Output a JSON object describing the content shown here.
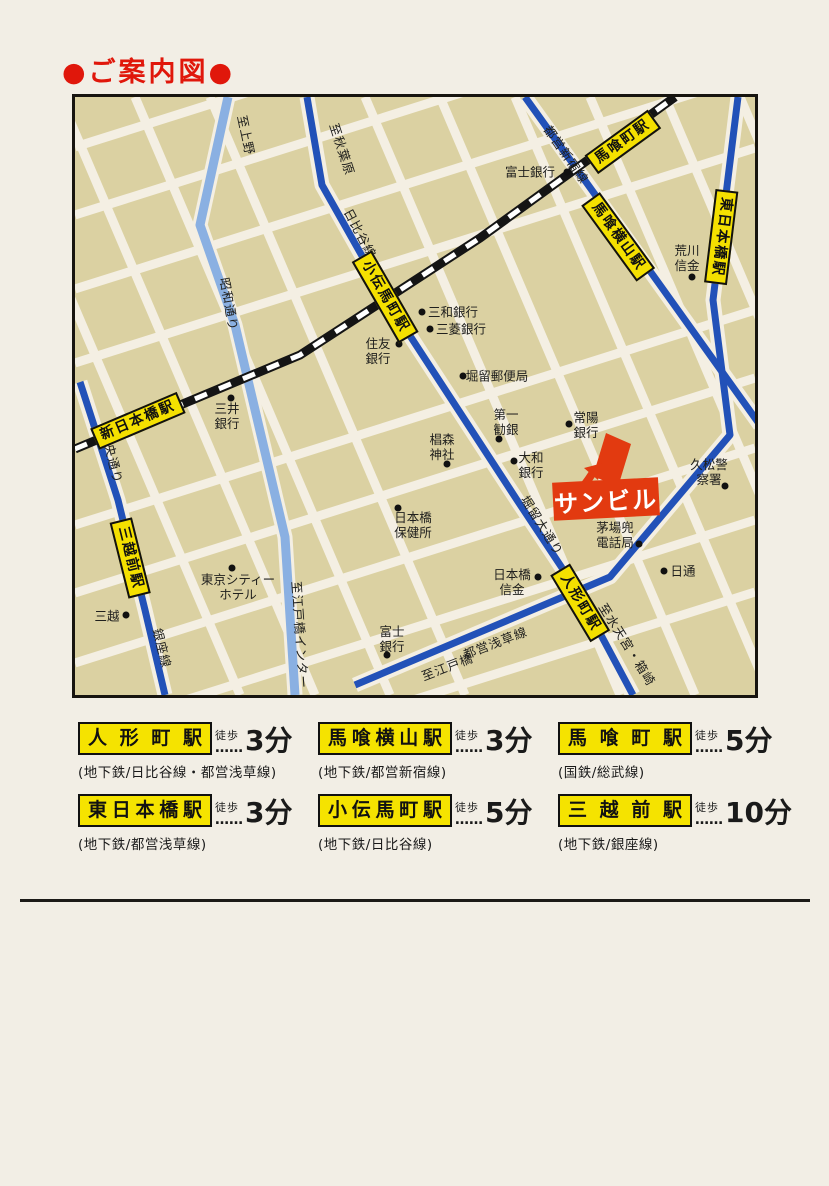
{
  "page": {
    "title": "●ご案内図●"
  },
  "colors": {
    "accent_red": "#e0170b",
    "map_bg": "#dbd1a2",
    "road_white": "#f4efe3",
    "subway_dark_blue": "#2251b8",
    "road_light_blue": "#8ab0e2",
    "station_yellow": "#f4e000",
    "building_red": "#e23a10",
    "railway_black": "#111111"
  },
  "map": {
    "building": {
      "name": "sun-building",
      "label": "サンビル"
    },
    "stations": [
      {
        "name": "shin-nihombashi",
        "text": "新日本橋駅",
        "x": 63,
        "y": 324,
        "rot": -23
      },
      {
        "name": "bakurocho",
        "text": "馬喰町駅",
        "x": 548,
        "y": 45,
        "rot": -36
      },
      {
        "name": "bakuro-yokoyama",
        "text": "馬喰横山駅",
        "x": 543,
        "y": 140,
        "rot": 54
      },
      {
        "name": "higashi-nihombashi",
        "text": "東日本橋駅",
        "x": 646,
        "y": 140,
        "rot": 97
      },
      {
        "name": "kodemmacho",
        "text": "小伝馬町駅",
        "x": 310,
        "y": 200,
        "rot": 60
      },
      {
        "name": "ningyocho",
        "text": "人形町駅",
        "x": 505,
        "y": 506,
        "rot": 59
      },
      {
        "name": "mitsukoshimae",
        "text": "三越前駅",
        "x": 55,
        "y": 461,
        "rot": 76
      }
    ],
    "line_labels": [
      {
        "name": "to-ueno",
        "text": "至上野",
        "x": 172,
        "y": 38,
        "rot": 78
      },
      {
        "name": "to-akihabara",
        "text": "至秋葉原",
        "x": 268,
        "y": 52,
        "rot": 72
      },
      {
        "name": "hibiya-line",
        "text": "日比谷線",
        "x": 286,
        "y": 136,
        "rot": 62
      },
      {
        "name": "toei-shinjuku-line",
        "text": "都営新宿線",
        "x": 492,
        "y": 57,
        "rot": 55
      },
      {
        "name": "showa-dori",
        "text": "昭和通り",
        "x": 155,
        "y": 207,
        "rot": 80
      },
      {
        "name": "chuo-dori",
        "text": "中央通り",
        "x": 38,
        "y": 360,
        "rot": 76
      },
      {
        "name": "ginza-line",
        "text": "銀座線",
        "x": 88,
        "y": 551,
        "rot": 76
      },
      {
        "name": "to-edobashi-inter",
        "text": "至江戸橋インター",
        "x": 226,
        "y": 538,
        "rot": 86
      },
      {
        "name": "horidome-odori",
        "text": "堀留大通り",
        "x": 468,
        "y": 428,
        "rot": 58
      },
      {
        "name": "to-edobashi",
        "text": "至江戸橋",
        "x": 372,
        "y": 569,
        "rot": -21
      },
      {
        "name": "toei-asakusa-line",
        "text": "都営浅草線",
        "x": 420,
        "y": 545,
        "rot": -21
      },
      {
        "name": "to-suitengu-hakozaki",
        "text": "至水天宮・箱崎",
        "x": 553,
        "y": 547,
        "rot": 58
      }
    ],
    "places": [
      {
        "name": "fuji-bank-top",
        "text": "富士銀行",
        "x": 455,
        "y": 75
      },
      {
        "name": "arakawa-shinkin",
        "text": "荒川\n信金",
        "x": 612,
        "y": 161
      },
      {
        "name": "sanwa-bank",
        "text": "三和銀行",
        "x": 378,
        "y": 215
      },
      {
        "name": "mitsubishi-bank",
        "text": "三菱銀行",
        "x": 386,
        "y": 232
      },
      {
        "name": "sumitomo-bank",
        "text": "住友\n銀行",
        "x": 303,
        "y": 254
      },
      {
        "name": "horidome-post-office",
        "text": "堀留郵便局",
        "x": 422,
        "y": 279
      },
      {
        "name": "mitsui-bank",
        "text": "三井\n銀行",
        "x": 152,
        "y": 319
      },
      {
        "name": "daiichi-kangin",
        "text": "第一\n勧銀",
        "x": 431,
        "y": 325
      },
      {
        "name": "joyo-bank",
        "text": "常陽\n銀行",
        "x": 511,
        "y": 328
      },
      {
        "name": "suginomori-shrine",
        "text": "椙森\n神社",
        "x": 367,
        "y": 350
      },
      {
        "name": "daiwa-bank",
        "text": "大和\n銀行",
        "x": 456,
        "y": 368
      },
      {
        "name": "hisamatsu-police",
        "text": "久松警察署",
        "x": 634,
        "y": 375
      },
      {
        "name": "kayaba-kabuto-tel",
        "text": "茅場兜\n電話局",
        "x": 540,
        "y": 438
      },
      {
        "name": "nittsu",
        "text": "日通",
        "x": 608,
        "y": 474
      },
      {
        "name": "nihombashi-shinkin",
        "text": "日本橋\n信金",
        "x": 437,
        "y": 485
      },
      {
        "name": "nihombashi-health",
        "text": "日本橋\n保健所",
        "x": 338,
        "y": 428
      },
      {
        "name": "tokyo-city-hotel",
        "text": "東京シティー\nホテル",
        "x": 163,
        "y": 490
      },
      {
        "name": "mitsukoshi",
        "text": "三越",
        "x": 32,
        "y": 519
      },
      {
        "name": "fuji-bank-bottom",
        "text": "富士\n銀行",
        "x": 317,
        "y": 542
      }
    ],
    "dots": [
      {
        "name": "dot-fuji-bank-top",
        "x": 492,
        "y": 75
      },
      {
        "name": "dot-arakawa-shinkin",
        "x": 617,
        "y": 180
      },
      {
        "name": "dot-sanwa-bank",
        "x": 347,
        "y": 215
      },
      {
        "name": "dot-mitsubishi-bank",
        "x": 355,
        "y": 232
      },
      {
        "name": "dot-sumitomo-bank",
        "x": 324,
        "y": 247
      },
      {
        "name": "dot-horidome-post",
        "x": 388,
        "y": 279
      },
      {
        "name": "dot-mitsui-bank",
        "x": 156,
        "y": 301
      },
      {
        "name": "dot-daiichi-kangin",
        "x": 424,
        "y": 342
      },
      {
        "name": "dot-joyo-bank",
        "x": 494,
        "y": 327
      },
      {
        "name": "dot-suginomori",
        "x": 372,
        "y": 367
      },
      {
        "name": "dot-daiwa-bank",
        "x": 439,
        "y": 364
      },
      {
        "name": "dot-hisamatsu-police",
        "x": 650,
        "y": 389
      },
      {
        "name": "dot-kayaba-kabuto",
        "x": 564,
        "y": 447
      },
      {
        "name": "dot-nittsu",
        "x": 589,
        "y": 474
      },
      {
        "name": "dot-nihombashi-shinkin",
        "x": 463,
        "y": 480
      },
      {
        "name": "dot-nihombashi-health",
        "x": 323,
        "y": 411
      },
      {
        "name": "dot-tokyo-city-hotel",
        "x": 157,
        "y": 471
      },
      {
        "name": "dot-mitsukoshi",
        "x": 51,
        "y": 518
      },
      {
        "name": "dot-fuji-bank-bottom",
        "x": 312,
        "y": 558
      }
    ]
  },
  "legend": {
    "walk_label": "徒歩",
    "leader": "……",
    "items": [
      {
        "station": "人形町駅",
        "time": "3分",
        "lines": "(地下鉄/日比谷線・都営浅草線)"
      },
      {
        "station": "馬喰横山駅",
        "time": "3分",
        "lines": "(地下鉄/都営新宿線)"
      },
      {
        "station": "馬喰町駅",
        "time": "5分",
        "lines": "(国鉄/総武線)"
      },
      {
        "station": "東日本橋駅",
        "time": "3分",
        "lines": "(地下鉄/都営浅草線)"
      },
      {
        "station": "小伝馬町駅",
        "time": "5分",
        "lines": "(地下鉄/日比谷線)"
      },
      {
        "station": "三越前駅",
        "time": "10分",
        "lines": "(地下鉄/銀座線)"
      }
    ]
  }
}
